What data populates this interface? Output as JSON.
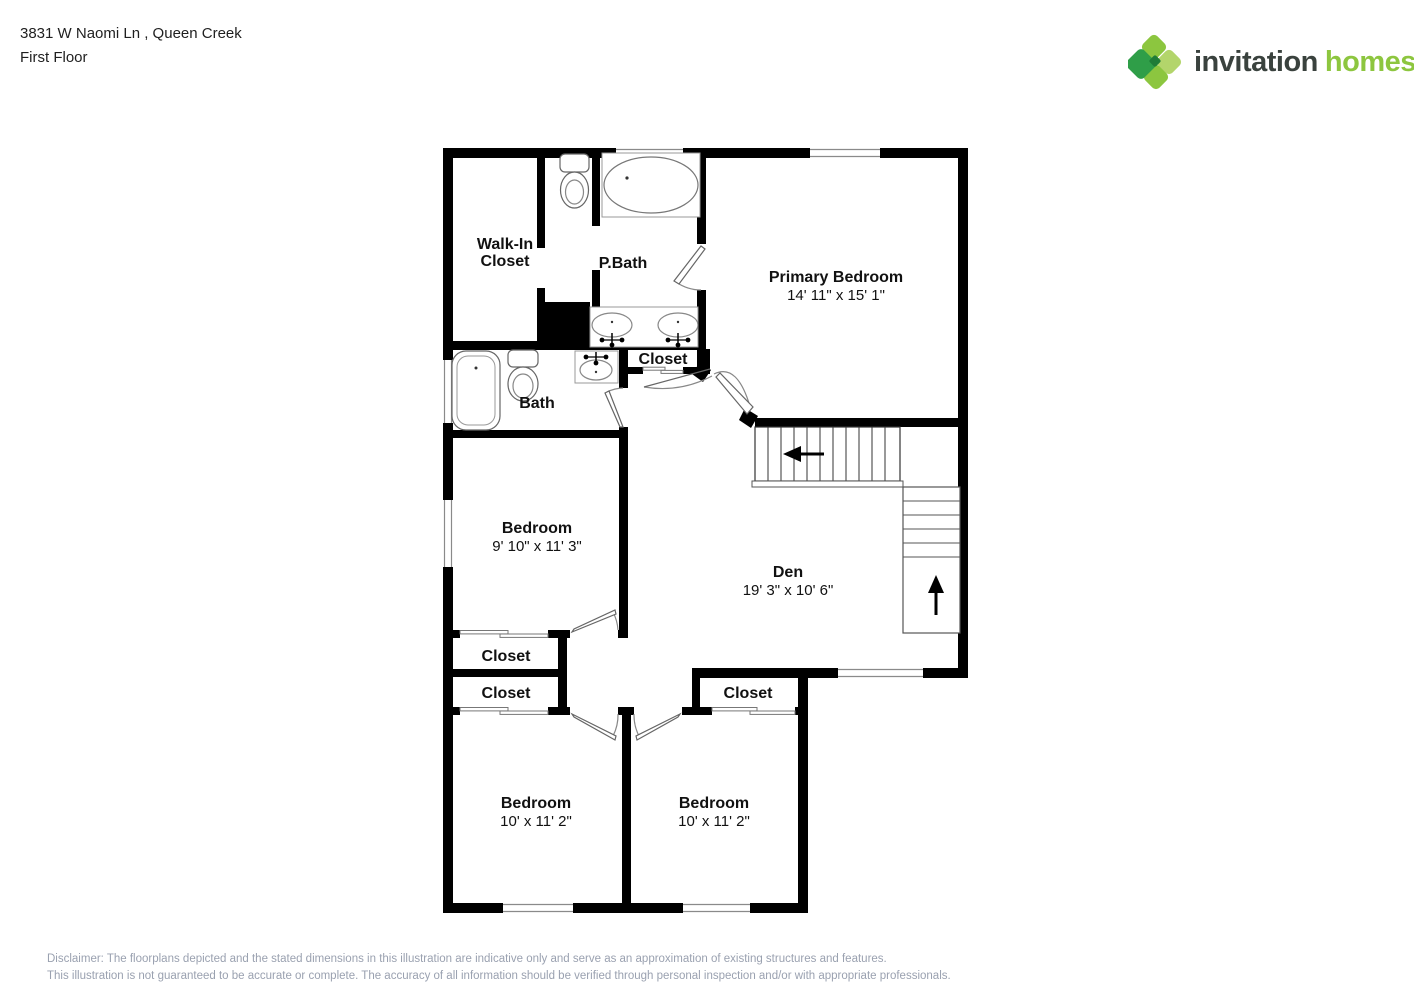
{
  "header": {
    "address": "3831 W Naomi Ln , Queen Creek",
    "floor": "First Floor"
  },
  "logo": {
    "brand_first": "invitation",
    "brand_second": "homes",
    "trademark": "™",
    "icon": "invitation-homes-diamond-cluster-icon",
    "colors": {
      "brand_green": "#8dc63f",
      "dark_green": "#2f9e48",
      "mid_green": "#8cc63f",
      "light_green": "#b3d56b",
      "brand_dark_text": "#3a423e"
    }
  },
  "rooms": {
    "walk_in_closet": {
      "line1": "Walk-In",
      "line2": "Closet"
    },
    "p_bath": {
      "label": "P.Bath"
    },
    "primary_bedroom": {
      "label": "Primary Bedroom",
      "dims": "14' 11\" x 15' 1\""
    },
    "closet_hall": {
      "label": "Closet"
    },
    "bath": {
      "label": "Bath"
    },
    "bedroom_mid": {
      "label": "Bedroom",
      "dims": "9' 10\" x 11' 3\""
    },
    "den": {
      "label": "Den",
      "dims": "19' 3\" x 10' 6\""
    },
    "closet_1": {
      "label": "Closet"
    },
    "closet_2": {
      "label": "Closet"
    },
    "closet_right": {
      "label": "Closet"
    },
    "bedroom_bl": {
      "label": "Bedroom",
      "dims": "10' x 11' 2\""
    },
    "bedroom_br": {
      "label": "Bedroom",
      "dims": "10' x 11' 2\""
    }
  },
  "icons": {
    "stairs_upper_direction": "left-arrow-icon",
    "stairs_lower_direction": "up-arrow-icon"
  },
  "colors": {
    "wall": "#000000",
    "fixture_line": "#666666",
    "disclaimer_text": "#9aa1b0"
  },
  "disclaimer": {
    "line1": "Disclaimer: The floorplans depicted and the stated dimensions in this illustration are indicative only and serve as an approximation of existing structures and features.",
    "line2": "This illustration is not guaranteed to be accurate or complete. The accuracy of all information should be verified through personal inspection and/or with appropriate professionals."
  }
}
